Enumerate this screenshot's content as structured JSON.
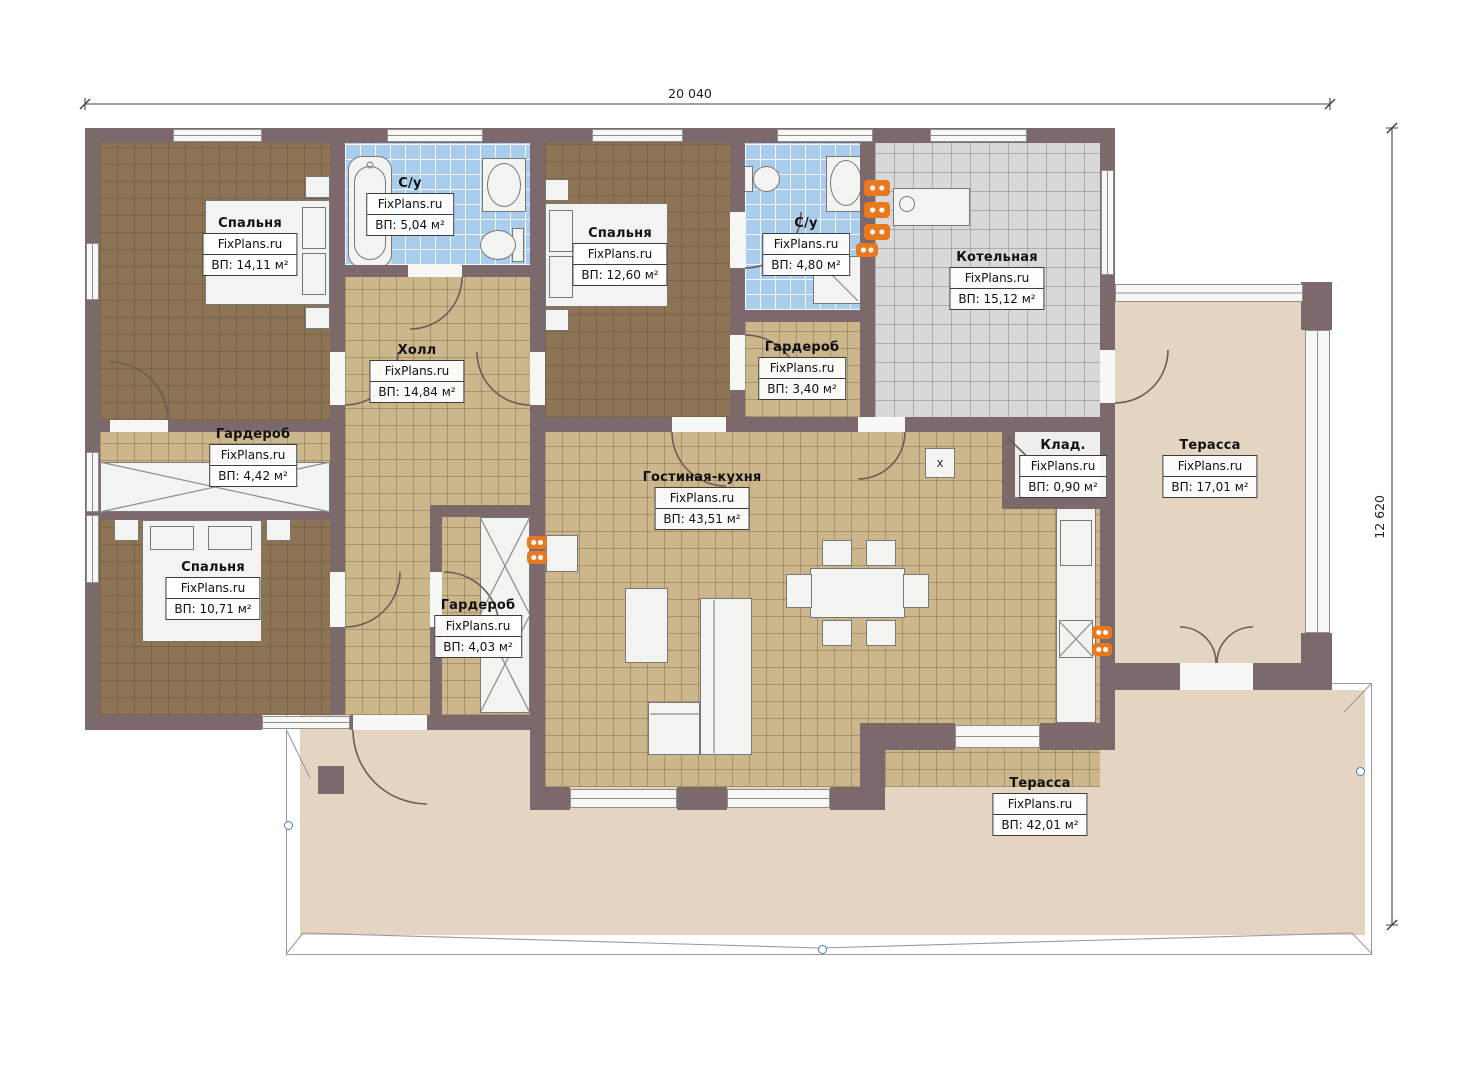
{
  "watermark": "FixPlans.ru",
  "dimensions": {
    "width_label": "20 040",
    "height_label": "12 620"
  },
  "markers": {
    "cross": "x"
  },
  "rooms": [
    {
      "id": "bedroom-1",
      "name": "Спальня",
      "watermark": "FixPlans.ru",
      "area": "ВП: 14,11 м²"
    },
    {
      "id": "bathroom-1",
      "name": "С/у",
      "watermark": "FixPlans.ru",
      "area": "ВП: 5,04 м²"
    },
    {
      "id": "bedroom-2",
      "name": "Спальня",
      "watermark": "FixPlans.ru",
      "area": "ВП: 12,60 м²"
    },
    {
      "id": "bathroom-2",
      "name": "С/у",
      "watermark": "FixPlans.ru",
      "area": "ВП: 4,80 м²"
    },
    {
      "id": "boiler-room",
      "name": "Котельная",
      "watermark": "FixPlans.ru",
      "area": "ВП: 15,12 м²"
    },
    {
      "id": "hall",
      "name": "Холл",
      "watermark": "FixPlans.ru",
      "area": "ВП: 14,84 м²"
    },
    {
      "id": "wardrobe-1",
      "name": "Гардероб",
      "watermark": "FixPlans.ru",
      "area": "ВП: 4,42 м²"
    },
    {
      "id": "wardrobe-2",
      "name": "Гардероб",
      "watermark": "FixPlans.ru",
      "area": "ВП: 3,40 м²"
    },
    {
      "id": "storage",
      "name": "Клад.",
      "watermark": "FixPlans.ru",
      "area": "ВП: 0,90 м²"
    },
    {
      "id": "terrace-right",
      "name": "Терасса",
      "watermark": "FixPlans.ru",
      "area": "ВП: 17,01 м²"
    },
    {
      "id": "living-kitchen",
      "name": "Гостиная-кухня",
      "watermark": "FixPlans.ru",
      "area": "ВП: 43,51 м²"
    },
    {
      "id": "bedroom-3",
      "name": "Спальня",
      "watermark": "FixPlans.ru",
      "area": "ВП: 10,71 м²"
    },
    {
      "id": "wardrobe-3",
      "name": "Гардероб",
      "watermark": "FixPlans.ru",
      "area": "ВП: 4,03 м²"
    },
    {
      "id": "terrace-main",
      "name": "Терасса",
      "watermark": "FixPlans.ru",
      "area": "ВП: 42,01 м²"
    }
  ],
  "colors": {
    "wall": "#7c696b",
    "bedroom_floor": "#8d7454",
    "tile_floor": "#ccb78d",
    "bath_floor": "#aacdee",
    "boiler_floor": "#d8d8d8",
    "terrace_floor": "#e3d5c1",
    "radiator": "#e8791e",
    "marker": "#4a7bc8"
  }
}
